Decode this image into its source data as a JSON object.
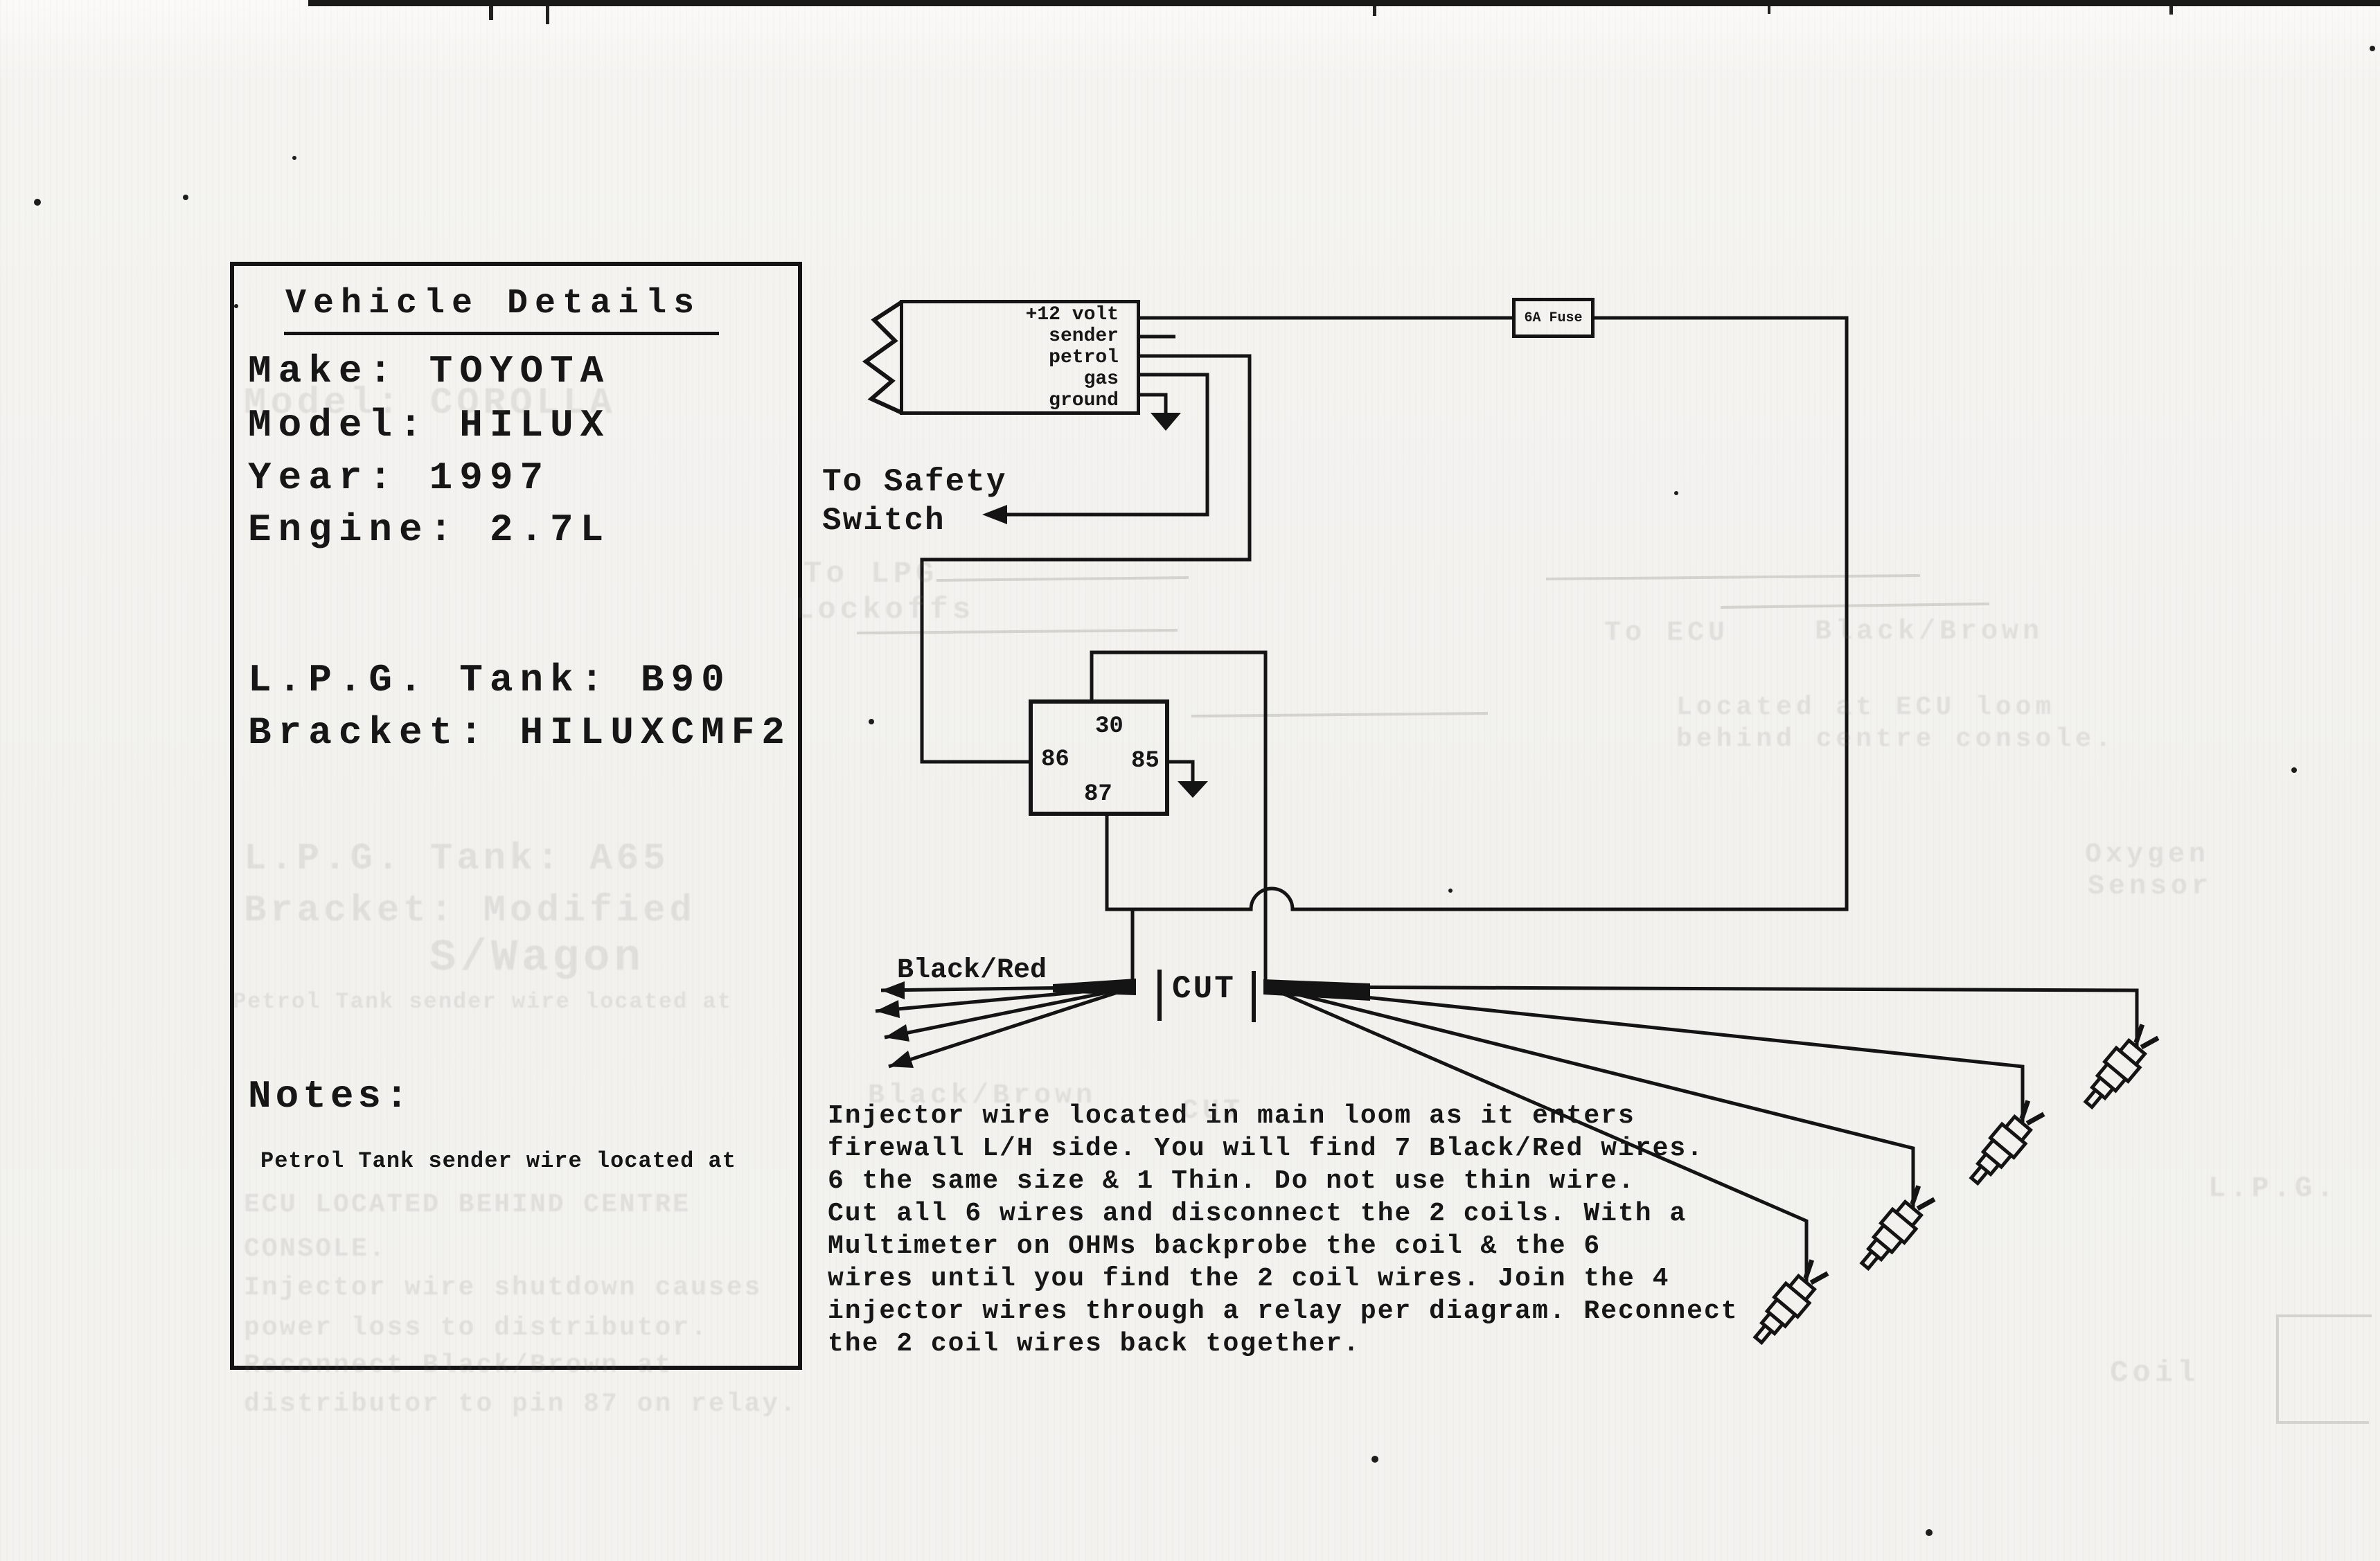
{
  "vehicle_box": {
    "title": "Vehicle Details",
    "make": "Make: TOYOTA",
    "model": "Model: HILUX",
    "year": "Year: 1997",
    "engine": "Engine: 2.7L",
    "tank": "L.P.G. Tank: B90",
    "bracket": "Bracket: HILUXCMF2",
    "notes_heading": "Notes:",
    "notes_detail": "Petrol Tank sender wire located at"
  },
  "sender_unit": {
    "pin1": "+12 volt",
    "pin2": "sender",
    "pin3": "petrol",
    "pin4": "gas",
    "pin5": "ground"
  },
  "fuse": {
    "label": "6A Fuse"
  },
  "safety_switch": {
    "line1": "To Safety",
    "line2": "Switch"
  },
  "relay": {
    "pin30": "30",
    "pin86": "86",
    "pin85": "85",
    "pin87": "87"
  },
  "loom": {
    "wire_color_label": "Black/Red",
    "cut_label": "CUT"
  },
  "instructions": {
    "line1": "Injector wire located in main loom as it enters",
    "line2": "firewall L/H side. You will find 7 Black/Red wires.",
    "line3": "6 the same size & 1 Thin. Do not use thin wire.",
    "line4": "Cut all 6 wires and disconnect the 2 coils. With a",
    "line5": "Multimeter on OHMs backprobe the coil & the 6",
    "line6": "wires until you find the 2 coil wires. Join the 4",
    "line7": "injector wires through a relay per diagram. Reconnect",
    "line8": "the 2 coil wires back together."
  },
  "ghost_bleedthrough": {
    "model": "Model: COROLLA",
    "tank": "L.P.G. Tank: A65",
    "bracket": "Bracket: Modified",
    "wagon": "S/Wagon",
    "petrol_note": "Petrol Tank sender wire located at",
    "ecu1": "ECU LOCATED BEHIND CENTRE",
    "ecu2": "CONSOLE.",
    "inj1": "Injector wire shutdown causes",
    "inj2": "power loss to distributor.",
    "inj3": "Reconnect Black/Brown at",
    "inj4": "distributor to pin 87 on relay.",
    "to_lpg": "To LPG",
    "lockoffs": "Lockoffs",
    "to_ecu": "To ECU",
    "black_brown": "Black/Brown",
    "located": "Located at ECU loom",
    "console": "behind centre console.",
    "oxygen": "Oxygen",
    "sensor": "Sensor",
    "black_brown2": "Black/Brown",
    "cut2": "CUT",
    "lpg": "L.P.G.",
    "coil": "Coil"
  }
}
